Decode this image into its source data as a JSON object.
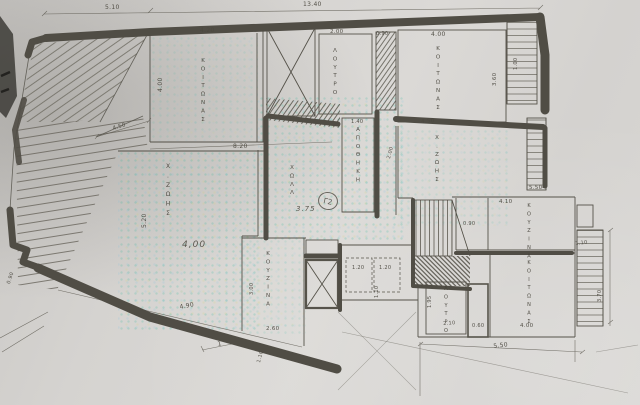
{
  "meta": {
    "document_type": "architectural floor plan (photographed drawing)",
    "language": "Greek",
    "apartment_unit": "Γ2"
  },
  "palette": {
    "paper": "#d5d3d0",
    "wall": "#504d45",
    "ink": "#4b483f",
    "scan_tint_green": "#00af8c",
    "scan_tint_yellow": "#d7d25a"
  },
  "badge": {
    "text": "Γ2"
  },
  "room_labels": [
    {
      "name": "bedroom-1-label",
      "text": "ΚΟΙΤΩΝΑΣ",
      "x": 203,
      "y": 58
    },
    {
      "name": "bathroom-1-label",
      "text": "ΛΟΥΤΡΟ",
      "x": 335,
      "y": 48
    },
    {
      "name": "bedroom-2-label",
      "text": "ΚΟΙΤΩΝΑΣ",
      "x": 438,
      "y": 46
    },
    {
      "name": "storage-label",
      "text": "ΑΠΟΘΗΚΗ",
      "x": 358,
      "y": 127
    },
    {
      "name": "hall-label",
      "text": "ΧΩΛΛ",
      "x": 292,
      "y": 165
    },
    {
      "name": "living-area-1-label",
      "text": "Χ.ΖΩΗΣ",
      "x": 168,
      "y": 163,
      "size": 6
    },
    {
      "name": "living-area-2-label",
      "text": "Χ.ΖΩΗΣ",
      "x": 437,
      "y": 135
    },
    {
      "name": "kitchen-1-label",
      "text": "ΚΟΥΖΙΝΑ",
      "x": 268,
      "y": 251
    },
    {
      "name": "kitchen-2-label",
      "text": "ΚΟΥΖΙΝΑ",
      "x": 529,
      "y": 203,
      "size": 5
    },
    {
      "name": "bedroom-3-label",
      "text": "ΚΟΙΤΩΝΑΣ",
      "x": 529,
      "y": 260,
      "size": 5
    },
    {
      "name": "bathroom-2-label",
      "text": "ΛΟΥΤΡΟ",
      "x": 446,
      "y": 286,
      "size": 5
    }
  ],
  "dimension_labels": [
    {
      "text": "5.10",
      "x": 105,
      "y": 4
    },
    {
      "text": "13.40",
      "x": 303,
      "y": 1
    },
    {
      "text": "4.20",
      "x": 200,
      "y": 27
    },
    {
      "text": "4.00",
      "x": 157,
      "y": 92,
      "rot": -90
    },
    {
      "text": "2.00",
      "x": 330,
      "y": 29,
      "size": 5.5
    },
    {
      "text": "0.90",
      "x": 376,
      "y": 31,
      "size": 5
    },
    {
      "text": "4.00",
      "x": 431,
      "y": 31
    },
    {
      "text": "3.60",
      "x": 492,
      "y": 86,
      "rot": -90,
      "size": 5.5
    },
    {
      "text": "1.00",
      "x": 513,
      "y": 70,
      "rot": -90,
      "size": 5
    },
    {
      "text": "4.50",
      "x": 112,
      "y": 126,
      "rot": -16,
      "size": 5.5
    },
    {
      "text": "8.20",
      "x": 233,
      "y": 143
    },
    {
      "text": "1.40",
      "x": 351,
      "y": 119,
      "size": 5
    },
    {
      "text": "4.50",
      "x": 421,
      "y": 119,
      "rot": -4,
      "size": 5.5
    },
    {
      "text": "2.00",
      "x": 386,
      "y": 158,
      "rot": -75,
      "size": 5
    },
    {
      "text": "5.20",
      "x": 141,
      "y": 228,
      "rot": -90
    },
    {
      "text": "4,00",
      "x": 182,
      "y": 240,
      "size": 9,
      "cls": "freehand"
    },
    {
      "text": "3.75",
      "x": 296,
      "y": 205,
      "size": 7,
      "cls": "freehand"
    },
    {
      "text": "3.00",
      "x": 249,
      "y": 295,
      "rot": -90,
      "size": 5
    },
    {
      "text": "2.60",
      "x": 266,
      "y": 326,
      "size": 5.5
    },
    {
      "text": "4.90",
      "x": 179,
      "y": 304,
      "rot": -11
    },
    {
      "text": "1.20",
      "x": 352,
      "y": 265,
      "size": 5
    },
    {
      "text": "1.20",
      "x": 379,
      "y": 265,
      "size": 5
    },
    {
      "text": "1.10",
      "x": 374,
      "y": 298,
      "rot": -90,
      "size": 5
    },
    {
      "text": "1.95",
      "x": 427,
      "y": 308,
      "rot": -90,
      "size": 5
    },
    {
      "text": "2.10",
      "x": 443,
      "y": 321,
      "rot": -4,
      "size": 5
    },
    {
      "text": "0.60",
      "x": 472,
      "y": 323,
      "size": 5
    },
    {
      "text": "4.00",
      "x": 520,
      "y": 323,
      "size": 5.5
    },
    {
      "text": "4.10",
      "x": 499,
      "y": 199,
      "size": 5.5
    },
    {
      "text": "5.50",
      "x": 529,
      "y": 185,
      "size": 5.5
    },
    {
      "text": "1.10",
      "x": 575,
      "y": 241,
      "rot": -6,
      "size": 5
    },
    {
      "text": "3.70",
      "x": 597,
      "y": 302,
      "rot": -90,
      "size": 5
    },
    {
      "text": "0.90",
      "x": 463,
      "y": 221,
      "size": 5
    },
    {
      "text": "5.50",
      "x": 493,
      "y": 343,
      "rot": -7
    },
    {
      "text": "0.90",
      "x": 6,
      "y": 283,
      "rot": -72,
      "size": 5
    },
    {
      "text": "1.10",
      "x": 256,
      "y": 362,
      "rot": -75,
      "size": 5
    },
    {
      "text": "1",
      "x": 217,
      "y": 341,
      "rot": -12,
      "size": 6
    }
  ]
}
